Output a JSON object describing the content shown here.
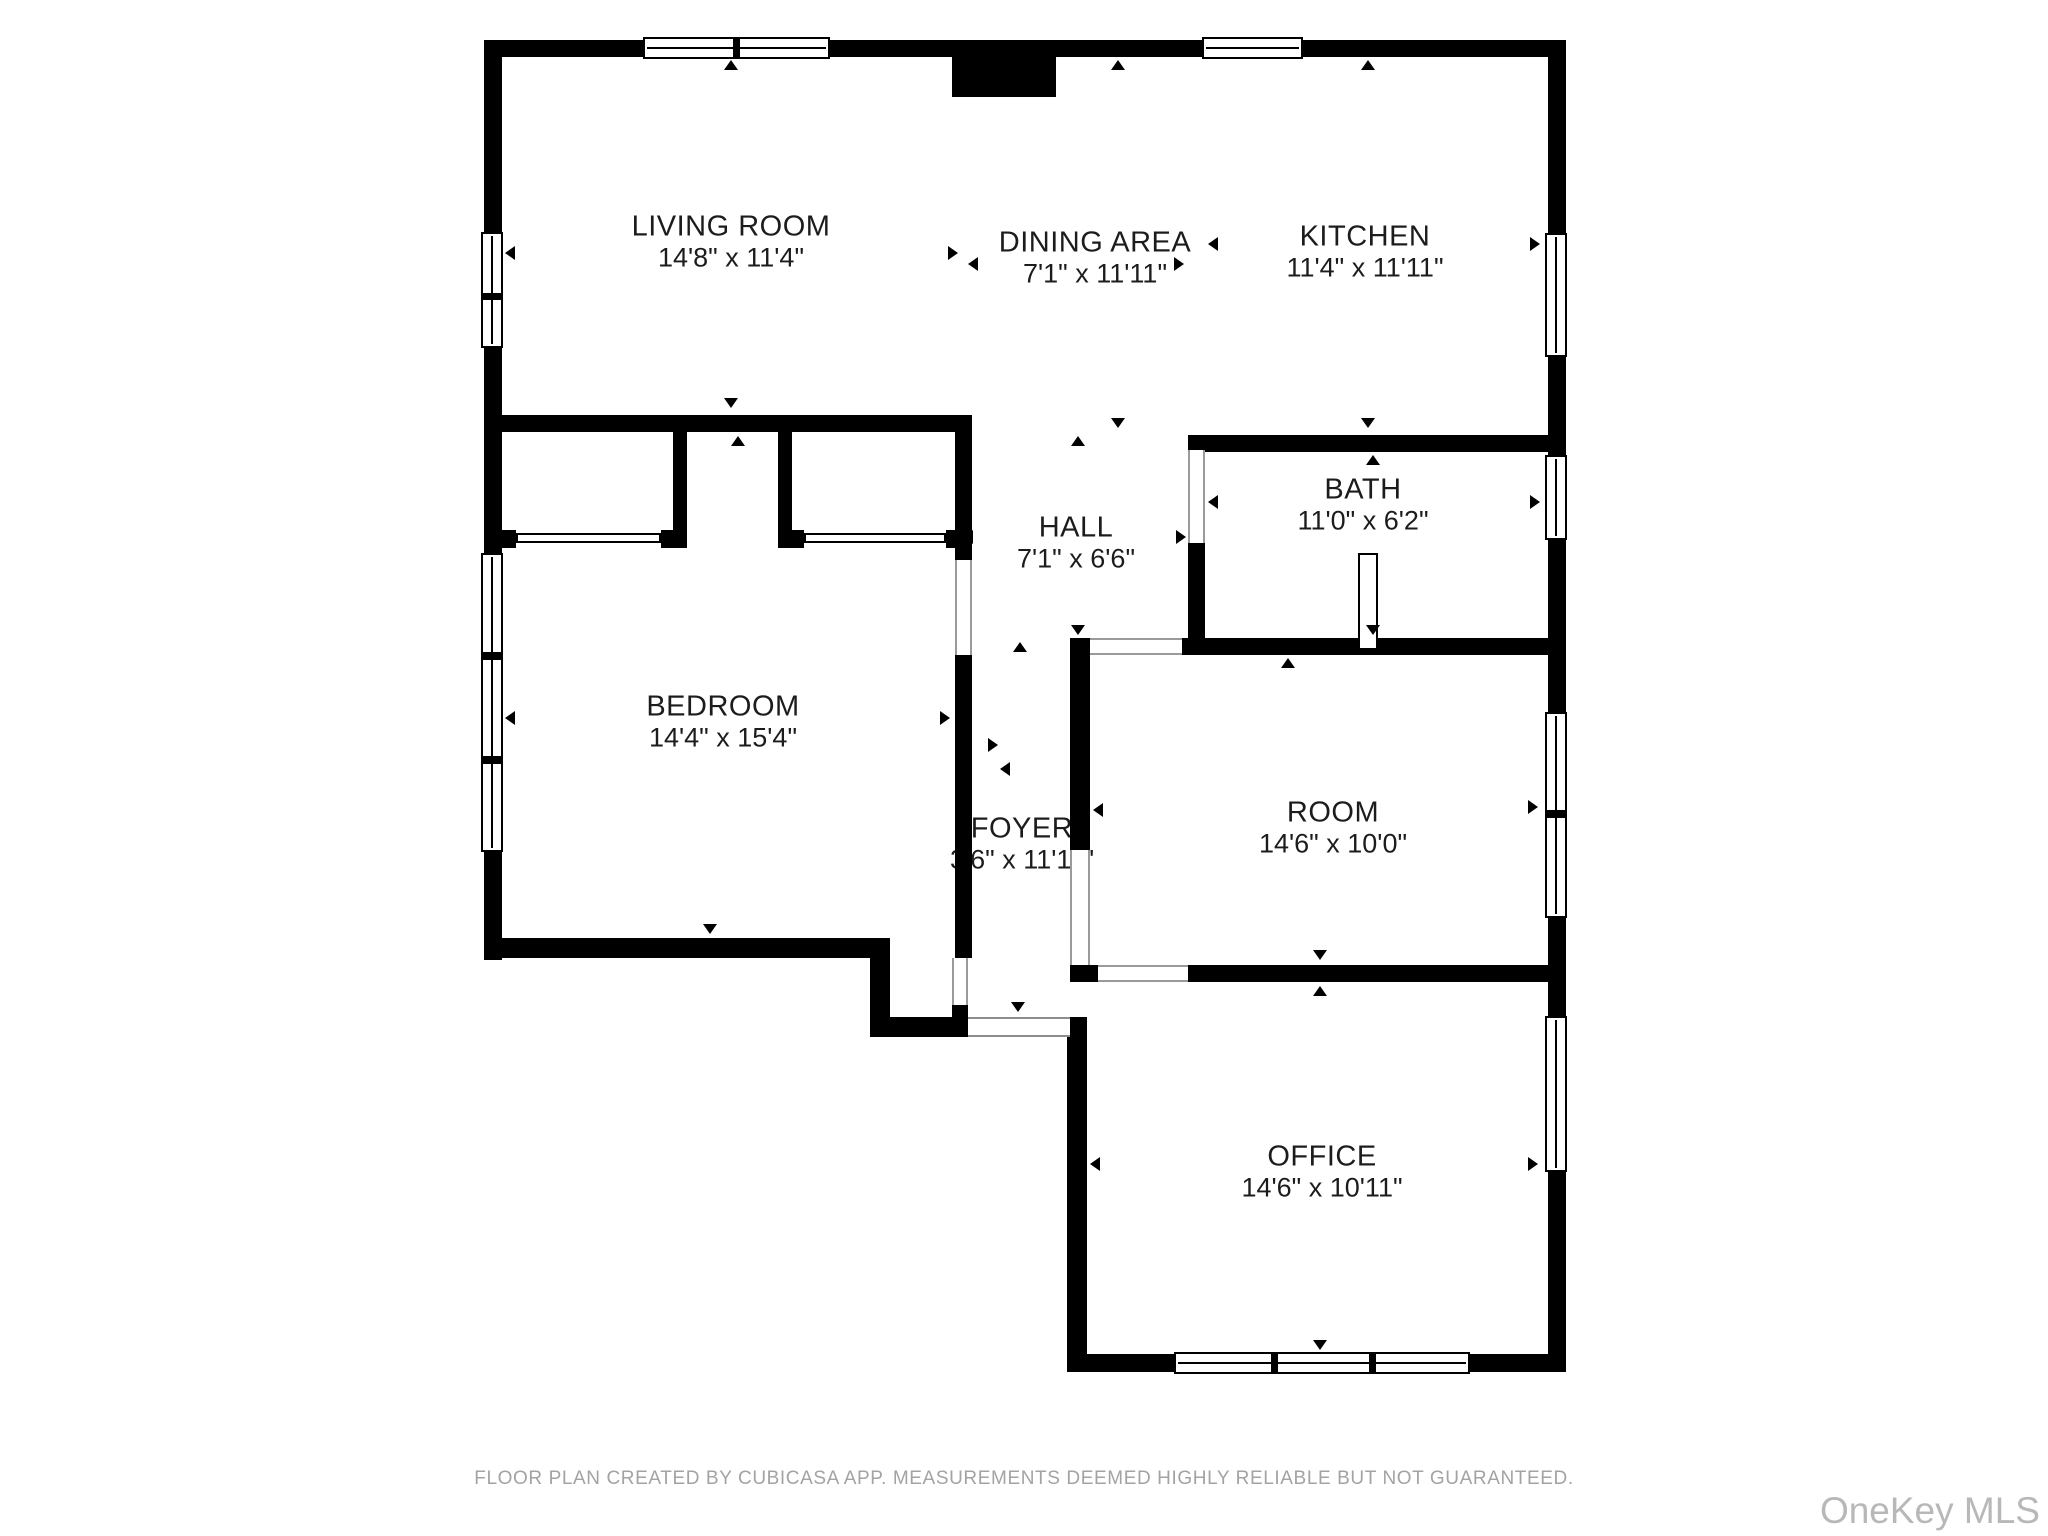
{
  "plan": {
    "creator_note": "FLOOR PLAN CREATED BY CUBICASA APP. MEASUREMENTS DEEMED HIGHLY RELIABLE BUT NOT GUARANTEED.",
    "watermark": "OneKey MLS",
    "rooms": [
      {
        "id": "living-room",
        "name": "LIVING ROOM",
        "dims": "14'8\" x 11'4\""
      },
      {
        "id": "dining-area",
        "name": "DINING AREA",
        "dims": "7'1\" x 11'11\""
      },
      {
        "id": "kitchen",
        "name": "KITCHEN",
        "dims": "11'4\" x 11'11\""
      },
      {
        "id": "hall",
        "name": "HALL",
        "dims": "7'1\" x 6'6\""
      },
      {
        "id": "bath",
        "name": "BATH",
        "dims": "11'0\" x 6'2\""
      },
      {
        "id": "bedroom",
        "name": "BEDROOM",
        "dims": "14'4\" x 15'4\""
      },
      {
        "id": "foyer",
        "name": "FOYER",
        "dims": "3'6\" x 11'11\""
      },
      {
        "id": "room",
        "name": "ROOM",
        "dims": "14'6\" x 10'0\""
      },
      {
        "id": "office",
        "name": "OFFICE",
        "dims": "14'6\" x 10'11\""
      }
    ],
    "colors": {
      "wall": "#000000",
      "label_text": "#1c1c1c",
      "footer_text": "#a3a3a3",
      "watermark_text": "#b8b8b8",
      "background": "#ffffff"
    }
  }
}
